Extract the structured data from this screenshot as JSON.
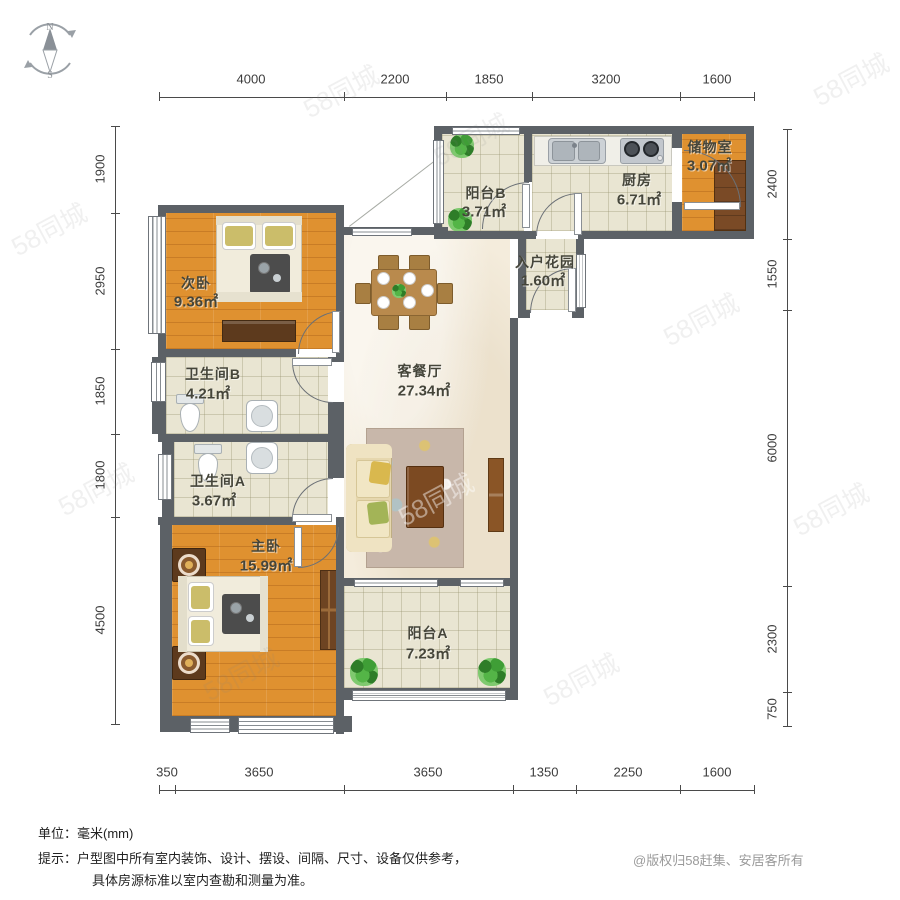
{
  "compass": {
    "north": "N",
    "south": "S"
  },
  "watermark": {
    "text": "58同城"
  },
  "rooms": [
    {
      "id": "balcony-b",
      "name": "阳台B",
      "area": "3.71㎡"
    },
    {
      "id": "kitchen",
      "name": "厨房",
      "area": "6.71㎡"
    },
    {
      "id": "storage",
      "name": "储物室",
      "area": "3.07㎡"
    },
    {
      "id": "entry-garden",
      "name": "入户花园",
      "area": "1.60㎡"
    },
    {
      "id": "second-bedroom",
      "name": "次卧",
      "area": "9.36㎡"
    },
    {
      "id": "living-dining",
      "name": "客餐厅",
      "area": "27.34㎡"
    },
    {
      "id": "bathroom-b",
      "name": "卫生间B",
      "area": "4.21㎡"
    },
    {
      "id": "bathroom-a",
      "name": "卫生间A",
      "area": "3.67㎡"
    },
    {
      "id": "master-bedroom",
      "name": "主卧",
      "area": "15.99㎡"
    },
    {
      "id": "balcony-a",
      "name": "阳台A",
      "area": "7.23㎡"
    }
  ],
  "dimensions": {
    "top": [
      "4000",
      "2200",
      "1850",
      "3200",
      "1600"
    ],
    "bottom": [
      "350",
      "3650",
      "3650",
      "1350",
      "2250",
      "1600"
    ],
    "left": [
      "1900",
      "2950",
      "1850",
      "1800",
      "4500"
    ],
    "right": [
      "2400",
      "1550",
      "6000",
      "2300",
      "750"
    ]
  },
  "footer": {
    "unit_note": "单位：毫米(mm)",
    "tip_line1": "提示：户型图中所有室内装饰、设计、摆设、间隔、尺寸、设备仅供参考，",
    "tip_line2": "具体房源标准以室内查勘和测量为准。",
    "copyright": "@版权归58赶集、安居客所有"
  },
  "colors": {
    "wall": "#5c6166",
    "wood_floor": "#df9130",
    "tile_floor": "#e9e5d2",
    "living_floor": "#f4ecdc",
    "dark_wood": "#6e4422",
    "plant_green": "#54b547"
  }
}
